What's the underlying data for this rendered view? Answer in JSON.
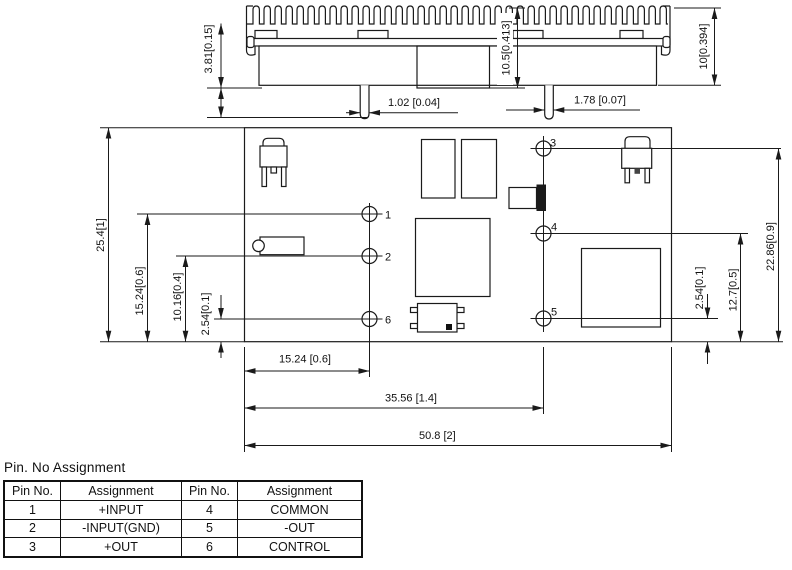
{
  "drawing": {
    "side_view": {
      "dim_standoff": "3.81[0.15]",
      "dim_mid_height": "10.5[0.413]",
      "dim_overall_height": "10[0.394]",
      "dim_pin_dia_small": "1.02 [0.04]",
      "dim_pin_dia_large": "1.78 [0.07]"
    },
    "plan_view": {
      "dim_board_height": "25.4[1]",
      "dim_pin1_y": "15.24[0.6]",
      "dim_pin2_y": "10.16[0.4]",
      "dim_pin6_y": "2.54[0.1]",
      "dim_pin5_y": "2.54[0.1]",
      "dim_pin4_y": "12.7[0.5]",
      "dim_pin3_y": "22.86[0.9]",
      "dim_pin_col1_x": "15.24 [0.6]",
      "dim_pin_col2_x": "35.56 [1.4]",
      "dim_board_width": "50.8 [2]",
      "pin_labels": [
        "1",
        "2",
        "3",
        "4",
        "5",
        "6"
      ]
    }
  },
  "pin_table": {
    "title": "Pin. No Assignment",
    "headers": [
      "Pin No.",
      "Assignment",
      "Pin No.",
      "Assignment"
    ],
    "rows": [
      [
        "1",
        "+INPUT",
        "4",
        "COMMON"
      ],
      [
        "2",
        "-INPUT(GND)",
        "5",
        "-OUT"
      ],
      [
        "3",
        "+OUT",
        "6",
        "CONTROL"
      ]
    ]
  },
  "colors": {
    "line": "#1a1a1a",
    "background": "#ffffff"
  }
}
